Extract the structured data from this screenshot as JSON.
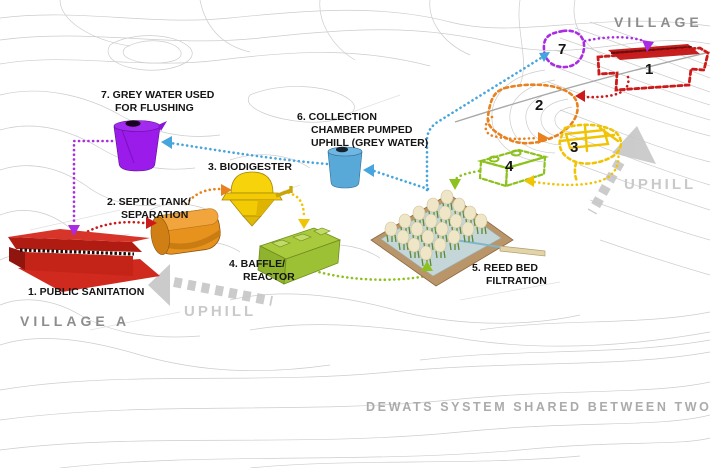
{
  "page": {
    "title": "DEWATS SYSTEM SHARED BETWEEN TWO VILLAGES"
  },
  "areas": {
    "village_a": "VILLAGE A",
    "village_b": "VILLAGE B",
    "uphill_left": "UPHILL",
    "uphill_right": "UPHILL"
  },
  "components": {
    "c1": {
      "line1": "1. PUBLIC SANITATION"
    },
    "c2": {
      "line1": "2. SEPTIC TANK/",
      "line2": "SEPARATION"
    },
    "c3": {
      "line1": "3. BIODIGESTER"
    },
    "c4": {
      "line1": "4. BAFFLE/",
      "line2": "REACTOR"
    },
    "c5": {
      "line1": "5. REED BED",
      "line2": "FILTRATION"
    },
    "c6": {
      "line1": "6. COLLECTION",
      "line2": "CHAMBER PUMPED",
      "line3": "UPHILL (GREY WATER)"
    },
    "c7": {
      "line1": "7. GREY WATER USED",
      "line2": "FOR FLUSHING"
    }
  },
  "village_b_markers": {
    "m7": "7",
    "m1": "1",
    "m2": "2",
    "m3": "3",
    "m4": "4"
  },
  "colors": {
    "flow_purple": "#a92be2",
    "flow_red": "#cc1a1a",
    "flow_orange": "#e8811e",
    "flow_yellow": "#f0c405",
    "flow_green": "#8cc11e",
    "flow_blue": "#45a5dc",
    "tank_purple": "#9b1bea",
    "tank_blue": "#58a8d8",
    "tank_orange": "#e8921e",
    "tank_yellow": "#f6d30a",
    "tank_green": "#a9ca3c",
    "building_red": "#d02a1e",
    "reed_bed_frame": "#b99569",
    "reed_bed_water": "#c5d6d8",
    "map_line_gray": "#c9c9c9",
    "uphill_gray": "#c6c6c6"
  }
}
